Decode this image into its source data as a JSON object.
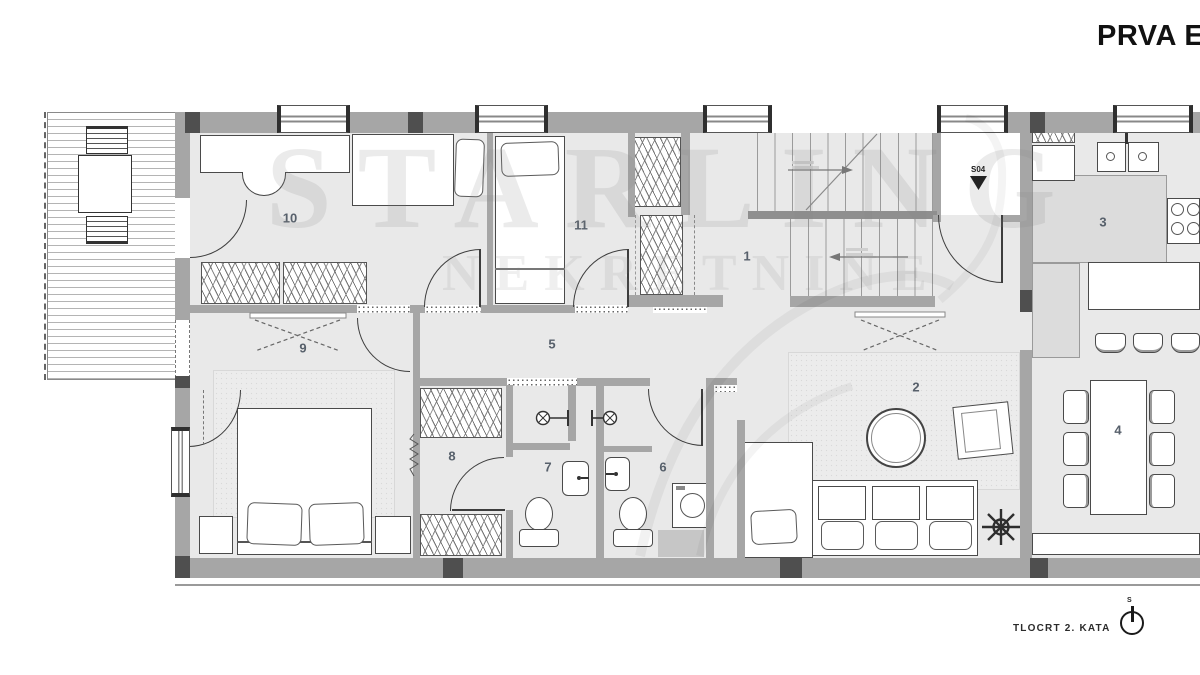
{
  "title": "PRVA E",
  "watermark": {
    "line1": "STARLING",
    "line2": "NEKRETNINE"
  },
  "rooms": {
    "r1": "1",
    "r2": "2",
    "r3": "3",
    "r4": "4",
    "r5": "5",
    "r6": "6",
    "r7": "7",
    "r8": "8",
    "r9": "9",
    "r10": "10",
    "r11": "11"
  },
  "entrance": {
    "unit_label": "S04"
  },
  "footer": {
    "label": "TLOCRT 2. KATA",
    "north_letter": "S"
  },
  "colors": {
    "wall": "#a6a6a6",
    "wall_dark": "#4f4f4f",
    "floor": "#e9e9e9",
    "counter": "#dcdcdc",
    "line": "#4a4a4a",
    "room_number": "#57606b"
  }
}
